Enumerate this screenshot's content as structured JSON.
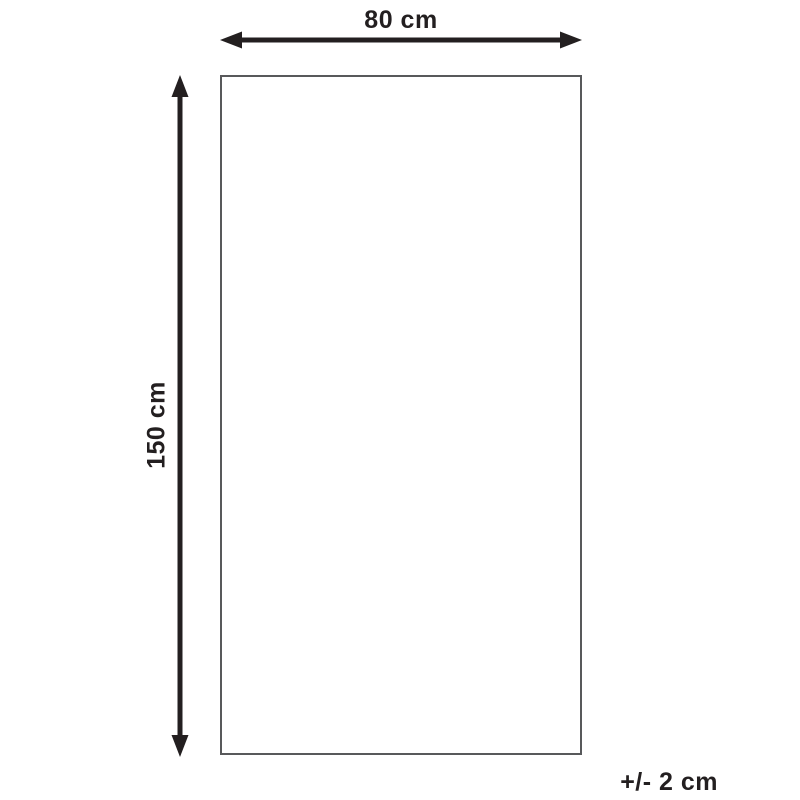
{
  "diagram": {
    "type": "product-dimension-diagram",
    "width_label": "80 cm",
    "height_label": "150 cm",
    "tolerance_label": "+/- 2 cm",
    "shape": "rectangle",
    "colors": {
      "arrow": "#231f20",
      "text": "#231f20",
      "rect_border": "#58595b",
      "background": "#ffffff"
    }
  }
}
